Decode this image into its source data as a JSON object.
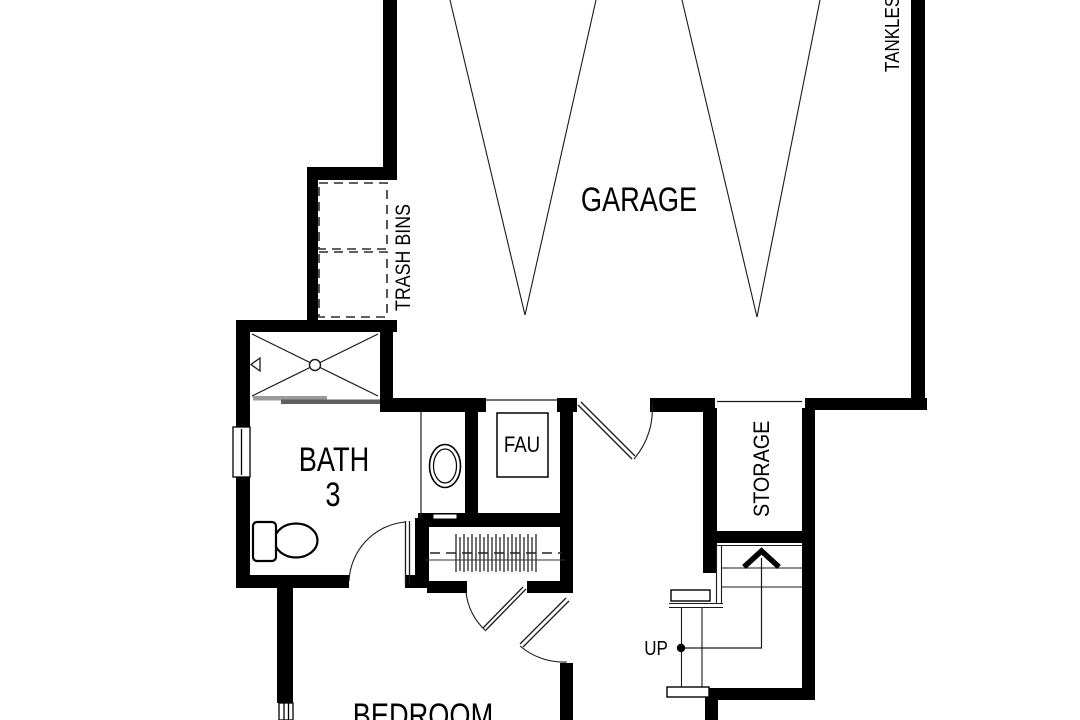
{
  "document": {
    "type": "floor-plan",
    "level": "garage-level"
  },
  "labels": {
    "garage": "GARAGE",
    "trash_bins": "TRASH BINS",
    "tankless": "TANKLESS",
    "bath": "BATH",
    "bath_number": "3",
    "fau": "FAU",
    "storage": "STORAGE",
    "up": "UP",
    "bedroom": "BEDROOM"
  },
  "colors": {
    "background": "#ffffff",
    "wall": "#000000",
    "line": "#1a1a1a",
    "shower_door_light": "#9a9a9a",
    "shower_door_dark": "#5f5f5f"
  },
  "icons": [
    "garage-parking-guides",
    "trash-bin-icon",
    "shower-icon",
    "toilet-icon",
    "sink-icon",
    "window-icon",
    "door-swing-icon",
    "closet-hangers-icon",
    "staircase-icon",
    "up-arrow-icon"
  ]
}
